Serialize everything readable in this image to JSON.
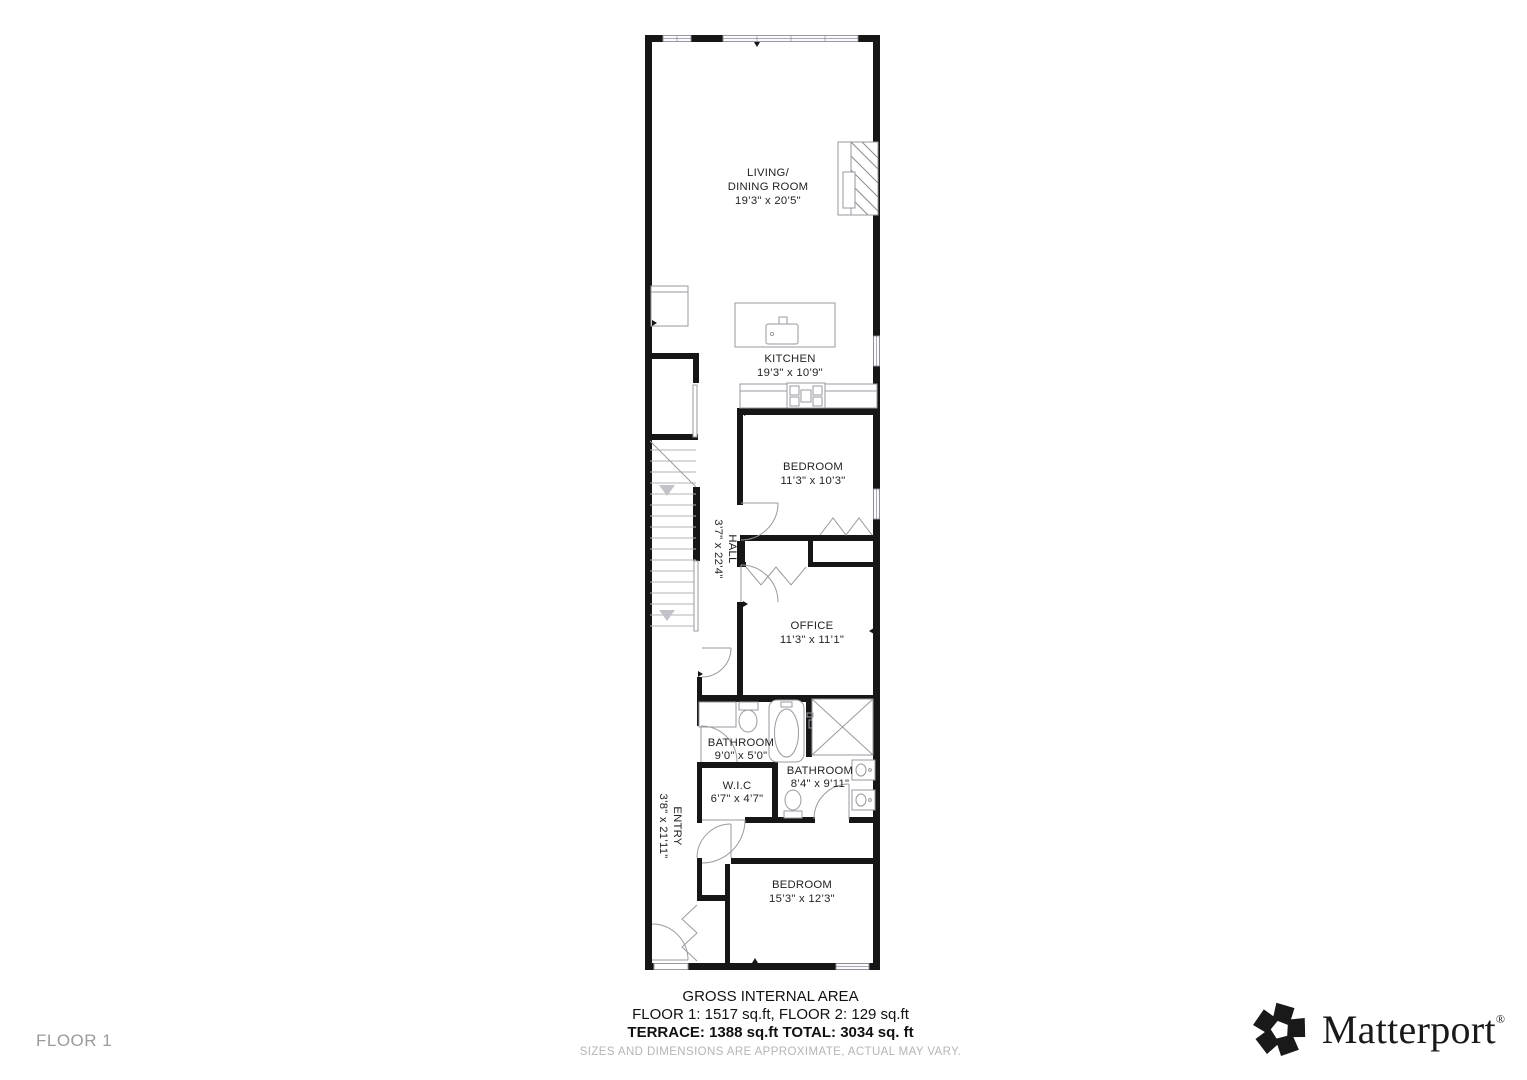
{
  "floor_label": "FLOOR 1",
  "footer": {
    "title": "GROSS INTERNAL AREA",
    "areas_line": "FLOOR 1: 1517 sq.ft, FLOOR 2: 129 sq.ft",
    "totals_line": "TERRACE: 1388 sq.ft TOTAL: 3034 sq. ft",
    "disclaimer": "SIZES AND DIMENSIONS ARE APPROXIMATE, ACTUAL MAY VARY."
  },
  "brand": {
    "name": "Matterport",
    "registered_mark": "®"
  },
  "rooms": {
    "living_dining": {
      "line1": "LIVING/",
      "line2": "DINING ROOM",
      "dims": "19’3\" x 20’5\""
    },
    "kitchen": {
      "label": "KITCHEN",
      "dims": "19’3\" x 10’9\""
    },
    "bedroom_1": {
      "label": "BEDROOM",
      "dims": "11’3\" x 10’3\""
    },
    "hall": {
      "label": "HALL",
      "dims": "3’7\" x 22’4\""
    },
    "office": {
      "label": "OFFICE",
      "dims": "11’3\" x 11’1\""
    },
    "bathroom_1": {
      "label": "BATHROOM",
      "dims": "9’0\" x 5’0\""
    },
    "bathroom_2": {
      "label": "BATHROOM",
      "dims": "8’4\" x 9’11\""
    },
    "wic": {
      "label": "W.I.C",
      "dims": "6’7\" x 4’7\""
    },
    "entry": {
      "label": "ENTRY",
      "dims": "3’8\" x 21’11\""
    },
    "bedroom_2": {
      "label": "BEDROOM",
      "dims": "15’3\" x 12’3\""
    }
  }
}
